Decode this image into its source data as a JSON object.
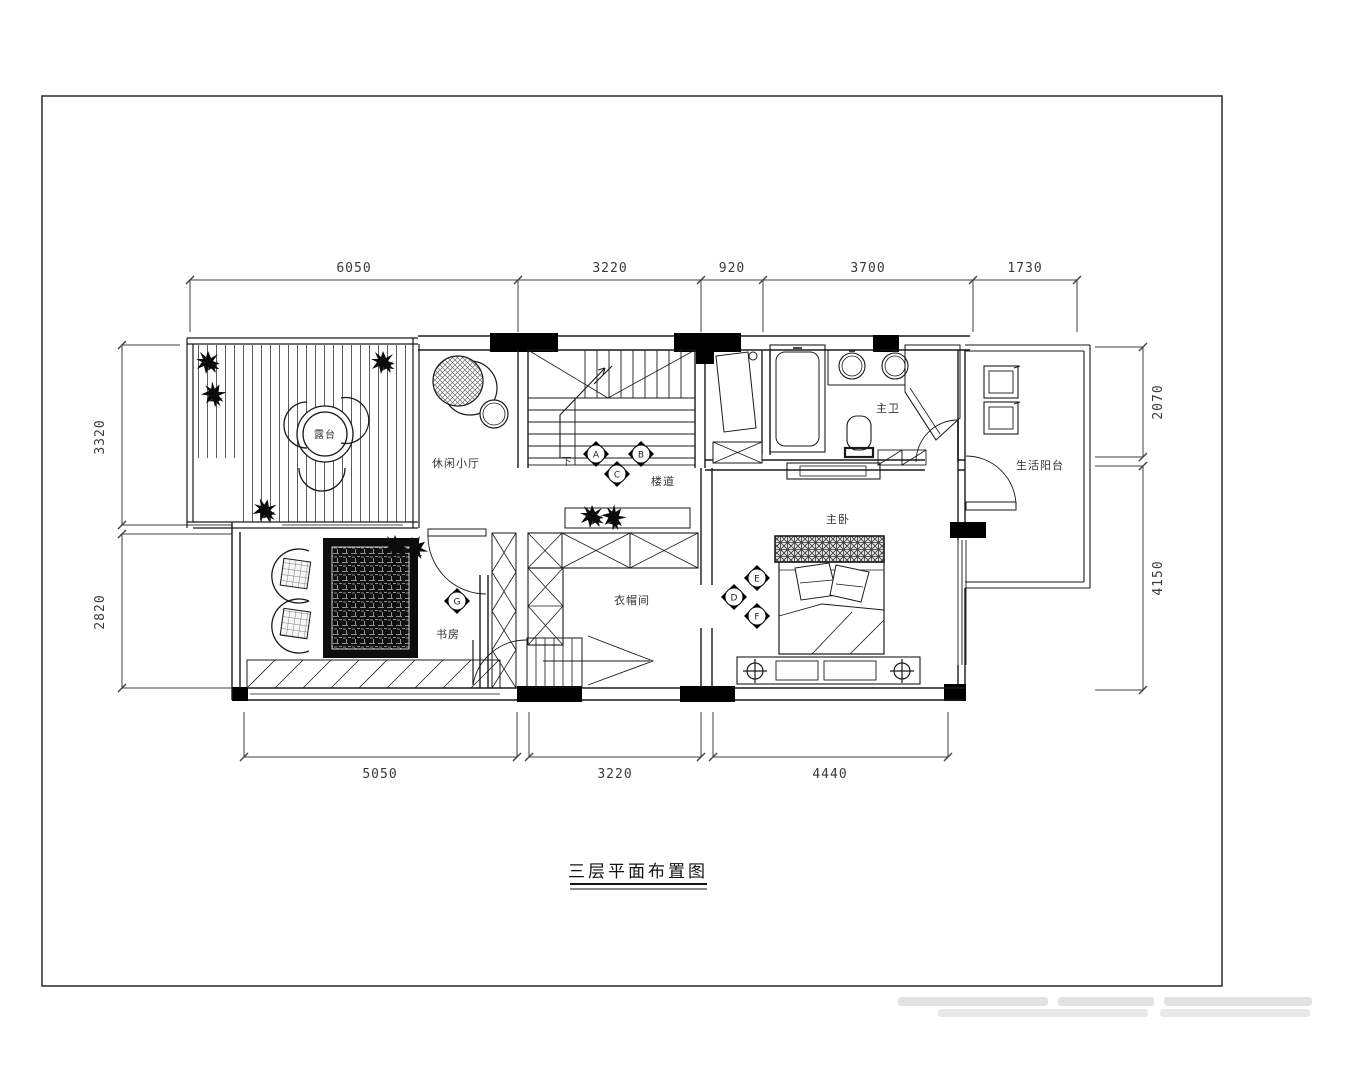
{
  "title": {
    "text": "三层平面布置图"
  },
  "rooms": {
    "terrace": "露台",
    "lounge": "休闲小厅",
    "stairwell": "楼道",
    "stair_down": "下",
    "master_bath": "主卫",
    "utility_balcony": "生活阳台",
    "master_bedroom": "主卧",
    "cloakroom": "衣帽间",
    "study": "书房"
  },
  "dimensions": {
    "top": [
      "6050",
      "3220",
      "920",
      "3700",
      "1730"
    ],
    "bottom": [
      "5050",
      "3220",
      "4440"
    ],
    "left": [
      "3320",
      "2820"
    ],
    "right": [
      "2070",
      "4150"
    ]
  },
  "markers": {
    "stair": [
      "A",
      "B",
      "C"
    ],
    "bedroom": [
      "E",
      "D",
      "F"
    ],
    "study": [
      "G"
    ]
  },
  "colors": {
    "line": "#1a1a1a",
    "dim_text": "#3a3a3a",
    "fill_dark": "#0d0d0d"
  }
}
